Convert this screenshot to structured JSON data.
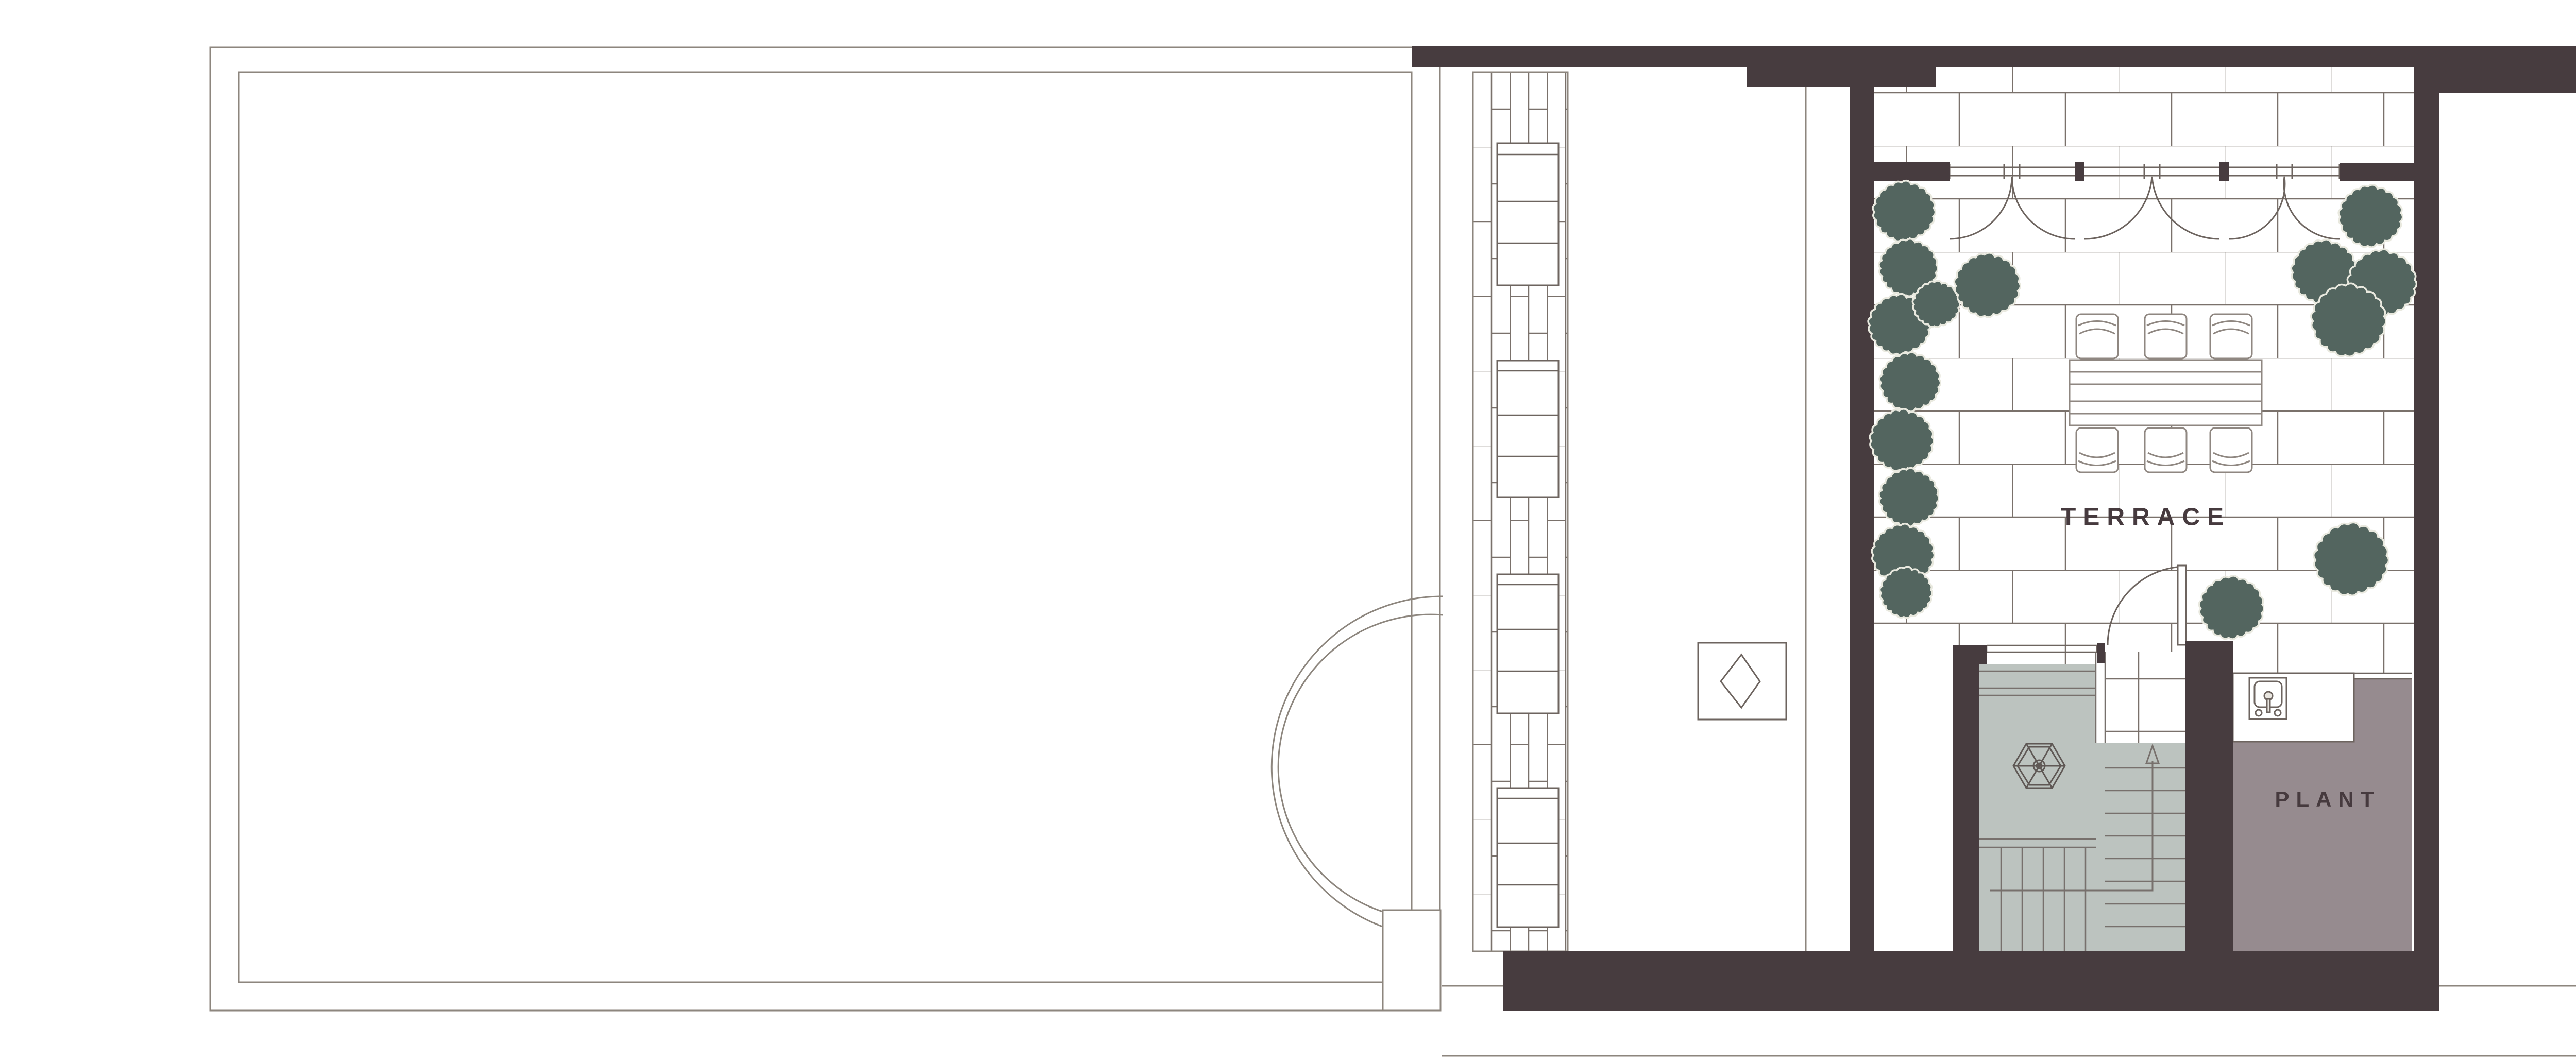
{
  "document": {
    "type": "architectural-floor-plan",
    "view": "terrace-roof-level"
  },
  "labels": {
    "terrace": "TERRACE",
    "plant": "PLANT"
  },
  "rooms": [
    {
      "name": "terrace",
      "label": "TERRACE",
      "floor": "stone-paving-running-bond",
      "features": [
        "dining-table",
        "6-chairs",
        "bushes",
        "drape-windows-3-bays",
        "swing-door"
      ]
    },
    {
      "name": "plant-room",
      "label": "PLANT",
      "floor": "solid-taupe",
      "features": [
        "sink-unit",
        "counter"
      ]
    },
    {
      "name": "stair-core",
      "label": "",
      "floor": "solid-grey",
      "features": [
        "hexagonal-skylight-wheel",
        "two-flights",
        "up-direction-arrow"
      ]
    },
    {
      "name": "left-roof",
      "label": "",
      "floor": "open-roof-outline",
      "features": [
        "semicircular-bay",
        "pier"
      ]
    },
    {
      "name": "right-roof-wing",
      "label": "",
      "floor": "open-roof-outline",
      "features": [
        "paved-plank-strip",
        "planter-boxes"
      ]
    }
  ],
  "icons": [
    "bush-icon",
    "sink-icon",
    "door-swing-icon",
    "stair-up-arrow-icon",
    "hex-skylight-icon",
    "diamond-rooflight-icon",
    "drape-window-icon"
  ],
  "counts": {
    "chairs": 6,
    "window_bays": 3,
    "bushes": 15,
    "planter_boxes_left_strip": 4,
    "planter_boxes_right_strip": 4
  },
  "colors": {
    "wall": "#473c3f",
    "thin_line": "#8d867e",
    "paving_joint": "#7a716b",
    "frame_line": "#6d645f",
    "furniture_line": "#8f8781",
    "bush_fill": "#53655f",
    "bush_outline": "#e9e9df",
    "stair_fill": "#bcc3bf",
    "stair_line": "#77706c",
    "plant_room_fill": "#968b8f",
    "label_text": "#463a3e",
    "paper": "#ffffff"
  }
}
